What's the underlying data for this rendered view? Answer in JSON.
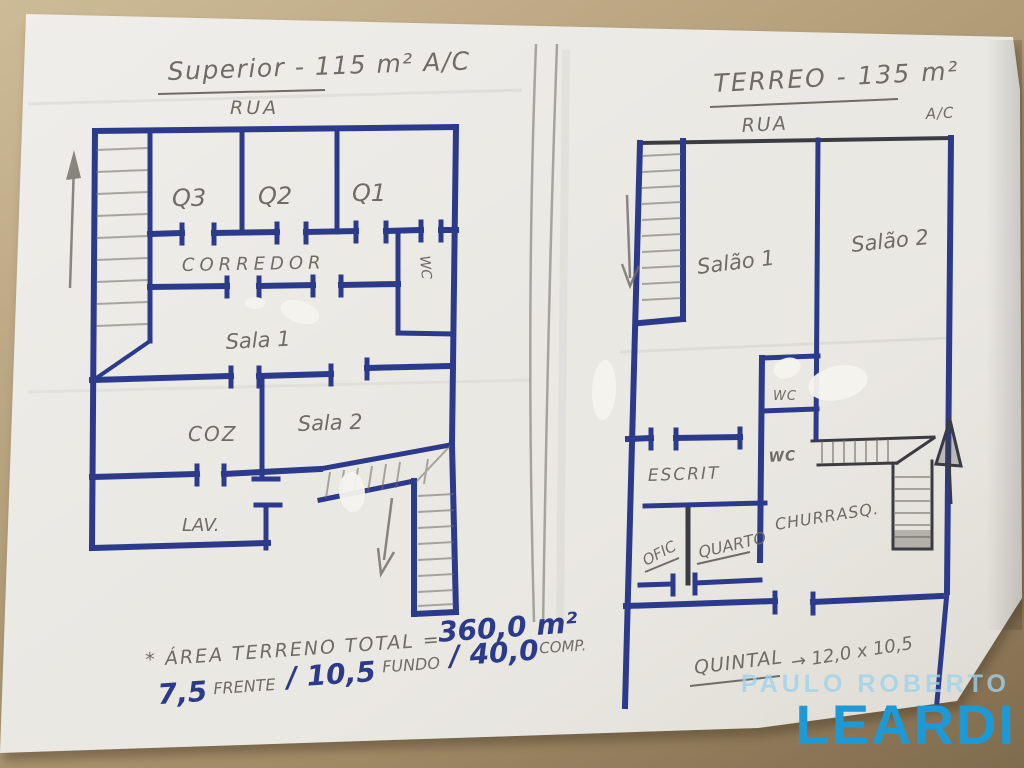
{
  "photo": {
    "colors": {
      "table": "#b4a07c",
      "paper": "#eae8e3",
      "ink": "#2c3a8c",
      "pencil": "#6f6c66",
      "black": "#3b3b42",
      "whiteout": "#f6f4ee",
      "logo_light": "#9ed3ec",
      "logo_bold": "#1d9ad6"
    }
  },
  "left_plan": {
    "title": "Superior - 115 m² A/C",
    "street": "RUA",
    "rooms": {
      "q3": "Q3",
      "q2": "Q2",
      "q1": "Q1",
      "corredor": "CORREDOR",
      "wc": "WC",
      "sala1": "Sala 1",
      "coz": "COZ",
      "sala2": "Sala 2",
      "lav": "LAV."
    }
  },
  "right_plan": {
    "title": "TERREO - 135 m²",
    "area_unit": "A/C",
    "street": "RUA",
    "rooms": {
      "salao1": "Salão 1",
      "salao2": "Salão 2",
      "wc_upper": "WC",
      "wc_lower": "WC",
      "escrit": "ESCRIT",
      "ofic": "OFIC",
      "quarto": "QUARTO",
      "churrasq": "CHURRASQ.",
      "quintal": "QUINTAL",
      "quintal_dims": "→ 12,0 x 10,5"
    }
  },
  "annotations": {
    "area_label": "* ÁREA TERRENO TOTAL =",
    "area_value": "360,0 m²",
    "front_value": "7,5",
    "front_label": "FRENTE",
    "depth_value": "/ 10,5",
    "depth_label": "FUNDO",
    "length_value": "/ 40,0",
    "length_label": "COMP."
  },
  "watermark": {
    "line1": "PAULO ROBERTO",
    "line2": "LEARDI"
  }
}
